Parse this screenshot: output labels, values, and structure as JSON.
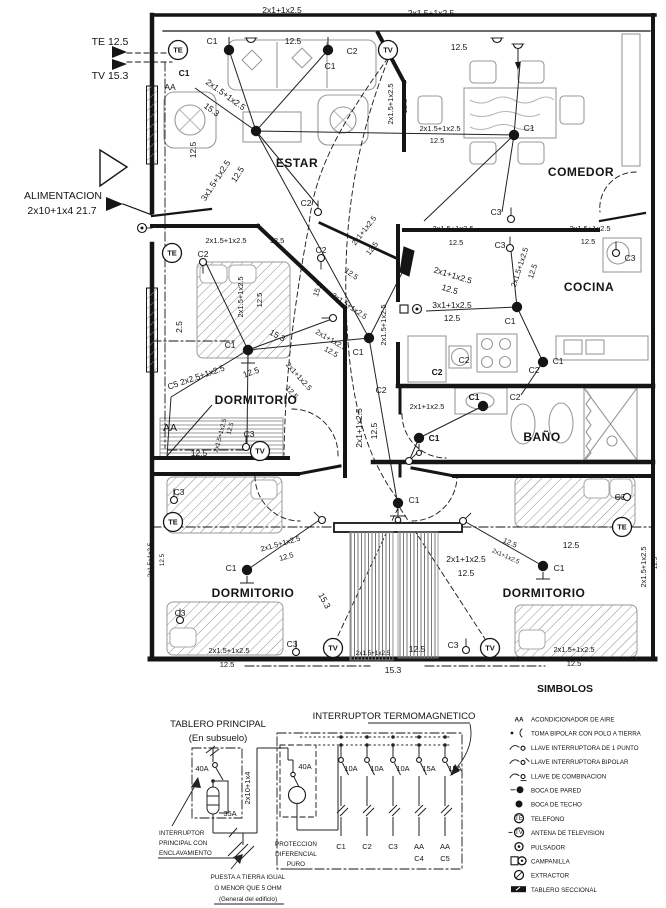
{
  "plan": {
    "feed": {
      "te": "TE 12.5",
      "tv": "TV 15.3",
      "alim1": "ALIMENTACION",
      "alim2": "2x10+1x4  21.7"
    },
    "rooms": [
      {
        "label": "ESTAR",
        "x": 297,
        "y": 167
      },
      {
        "label": "COMEDOR",
        "x": 581,
        "y": 176
      },
      {
        "label": "COCINA",
        "x": 589,
        "y": 291
      },
      {
        "label": "BAÑO",
        "x": 542,
        "y": 441
      },
      {
        "label": "DORMITORIO",
        "x": 256,
        "y": 404
      },
      {
        "label": "DORMITORIO",
        "x": 253,
        "y": 597
      },
      {
        "label": "DORMITORIO",
        "x": 544,
        "y": 597
      }
    ],
    "annotations": [
      {
        "t": "2x1+1x2.5",
        "x": 282,
        "y": 13
      },
      {
        "t": "12.5",
        "x": 293,
        "y": 44
      },
      {
        "t": "2x1.5+1x2.5",
        "x": 431,
        "y": 16
      },
      {
        "t": "12.5",
        "x": 459,
        "y": 50
      },
      {
        "t": "C1",
        "x": 212,
        "y": 44
      },
      {
        "t": "C2",
        "x": 352,
        "y": 54
      },
      {
        "t": "C1",
        "x": 330,
        "y": 69
      },
      {
        "t": "AA",
        "x": 170,
        "y": 90
      },
      {
        "t": "C1",
        "x": 184,
        "y": 76,
        "c": "bold"
      },
      {
        "t": "2x1.5+1x2.5",
        "x": 224,
        "y": 97,
        "r": 36
      },
      {
        "t": "15.3",
        "x": 210,
        "y": 112,
        "r": 36
      },
      {
        "t": "12.5",
        "x": 196,
        "y": 150,
        "r": -90
      },
      {
        "t": "3x1.5+1x2.5",
        "x": 218,
        "y": 182,
        "r": -57
      },
      {
        "t": "12.5",
        "x": 240,
        "y": 176,
        "r": -57
      },
      {
        "t": "C2",
        "x": 306,
        "y": 206
      },
      {
        "t": "2x1.5+1x2.5",
        "x": 393,
        "y": 104,
        "r": -90,
        "c": "sm"
      },
      {
        "t": "12.5",
        "x": 407,
        "y": 106,
        "r": -90,
        "c": "sm"
      },
      {
        "t": "C1",
        "x": 529,
        "y": 131
      },
      {
        "t": "2x1.5+1x2.5",
        "x": 440,
        "y": 131,
        "c": "sm"
      },
      {
        "t": "12.5",
        "x": 437,
        "y": 143,
        "c": "sm"
      },
      {
        "t": "C3",
        "x": 496,
        "y": 215
      },
      {
        "t": "2x1.5+1x2.5",
        "x": 453,
        "y": 231,
        "c": "sm"
      },
      {
        "t": "12.5",
        "x": 456,
        "y": 245,
        "c": "sm"
      },
      {
        "t": "2x1.5+1x2.5",
        "x": 590,
        "y": 231,
        "c": "sm"
      },
      {
        "t": "12.5",
        "x": 588,
        "y": 244,
        "c": "sm"
      },
      {
        "t": "C3",
        "x": 500,
        "y": 248
      },
      {
        "t": "C3",
        "x": 630,
        "y": 261
      },
      {
        "t": "2x1.5+1x2.5",
        "x": 522,
        "y": 268,
        "r": -72,
        "c": "sm"
      },
      {
        "t": "12.5",
        "x": 535,
        "y": 272,
        "r": -72,
        "c": "sm"
      },
      {
        "t": "2x1+1x2.5",
        "x": 452,
        "y": 278,
        "r": 17
      },
      {
        "t": "12.5",
        "x": 449,
        "y": 292,
        "r": 17
      },
      {
        "t": "3x1+1x2.5",
        "x": 452,
        "y": 308
      },
      {
        "t": "12.5",
        "x": 452,
        "y": 321
      },
      {
        "t": "C1",
        "x": 510,
        "y": 324
      },
      {
        "t": "C2",
        "x": 464,
        "y": 363
      },
      {
        "t": "C2",
        "x": 534,
        "y": 373
      },
      {
        "t": "C1",
        "x": 558,
        "y": 364
      },
      {
        "t": "C2",
        "x": 437,
        "y": 375,
        "c": "bold"
      },
      {
        "t": "C2",
        "x": 381,
        "y": 393
      },
      {
        "t": "C1",
        "x": 358,
        "y": 355
      },
      {
        "t": "2x1.5+1x2.5",
        "x": 386,
        "y": 325,
        "r": -90,
        "c": "sm"
      },
      {
        "t": "2x1.5+1x2.5",
        "x": 348,
        "y": 308,
        "r": 34,
        "c": "sm"
      },
      {
        "t": "12.5",
        "x": 350,
        "y": 276,
        "r": 34,
        "c": "sm"
      },
      {
        "t": "2x1+1x2.5",
        "x": 366,
        "y": 232,
        "r": -52,
        "c": "sm"
      },
      {
        "t": "12.5",
        "x": 374,
        "y": 250,
        "r": -52,
        "c": "sm"
      },
      {
        "t": "15.3",
        "x": 320,
        "y": 290,
        "r": -72,
        "c": "sm"
      },
      {
        "t": "2x1.5+1x2.5",
        "x": 226,
        "y": 243,
        "c": "sm"
      },
      {
        "t": "12.5",
        "x": 277,
        "y": 243,
        "c": "sm"
      },
      {
        "t": "C2",
        "x": 203,
        "y": 257
      },
      {
        "t": "C2",
        "x": 321,
        "y": 253
      },
      {
        "t": "2x1.5+1x2.5",
        "x": 243,
        "y": 297,
        "r": -90,
        "c": "sm"
      },
      {
        "t": "12.5",
        "x": 262,
        "y": 300,
        "r": -90,
        "c": "sm"
      },
      {
        "t": "2.5",
        "x": 182,
        "y": 327,
        "r": -90
      },
      {
        "t": "C1",
        "x": 230,
        "y": 348
      },
      {
        "t": "15.3",
        "x": 276,
        "y": 338,
        "r": 28
      },
      {
        "t": "2x1+1x2.5",
        "x": 330,
        "y": 342,
        "r": 30,
        "c": "sm"
      },
      {
        "t": "12.5",
        "x": 330,
        "y": 354,
        "r": 30,
        "c": "sm"
      },
      {
        "t": "C5 2x2.5+1x2.5",
        "x": 197,
        "y": 380,
        "r": -19
      },
      {
        "t": "12.5",
        "x": 252,
        "y": 375,
        "r": -19
      },
      {
        "t": "2x1+1x2.5",
        "x": 297,
        "y": 378,
        "r": 48,
        "c": "sm"
      },
      {
        "t": "12.5",
        "x": 290,
        "y": 394,
        "r": 48,
        "c": "sm"
      },
      {
        "t": "2x1+1x2.5",
        "x": 362,
        "y": 428,
        "r": -90
      },
      {
        "t": "12.5",
        "x": 377,
        "y": 431,
        "r": -90
      },
      {
        "t": "AA",
        "x": 170,
        "y": 431,
        "c": "lg"
      },
      {
        "t": "12.5",
        "x": 199,
        "y": 456
      },
      {
        "t": "C3",
        "x": 249,
        "y": 437
      },
      {
        "t": "2x1.5+1x2.5",
        "x": 222,
        "y": 436,
        "r": -75,
        "c": "xs"
      },
      {
        "t": "12.5",
        "x": 232,
        "y": 429,
        "r": -75,
        "c": "xs"
      },
      {
        "t": "2x1+1x2.5",
        "x": 427,
        "y": 409,
        "c": "sm"
      },
      {
        "t": "C1",
        "x": 474,
        "y": 400,
        "c": "bold"
      },
      {
        "t": "C2",
        "x": 515,
        "y": 400
      },
      {
        "t": "C1",
        "x": 434,
        "y": 441,
        "c": "bold"
      },
      {
        "t": "C1",
        "x": 414,
        "y": 503
      },
      {
        "t": "15.3",
        "x": 322,
        "y": 602,
        "r": 62
      },
      {
        "t": "C3",
        "x": 179,
        "y": 495
      },
      {
        "t": "2x1.5+1x2.5",
        "x": 152,
        "y": 560,
        "r": -90,
        "c": "xs"
      },
      {
        "t": "12.5",
        "x": 164,
        "y": 560,
        "r": -90,
        "c": "xs"
      },
      {
        "t": "2x1.5+1x2.5",
        "x": 281,
        "y": 546,
        "r": -16,
        "c": "sm"
      },
      {
        "t": "12.5",
        "x": 287,
        "y": 559,
        "r": -16,
        "c": "sm"
      },
      {
        "t": "C1",
        "x": 231,
        "y": 571
      },
      {
        "t": "C3",
        "x": 180,
        "y": 616
      },
      {
        "t": "2x1.5+1x2.5",
        "x": 229,
        "y": 653,
        "c": "sm"
      },
      {
        "t": "12.5",
        "x": 227,
        "y": 667,
        "c": "sm"
      },
      {
        "t": "C3",
        "x": 292,
        "y": 647
      },
      {
        "t": "2x1.5+1x2.5",
        "x": 373,
        "y": 655,
        "c": "xs"
      },
      {
        "t": "12.5",
        "x": 417,
        "y": 652
      },
      {
        "t": "15.3",
        "x": 393,
        "y": 673
      },
      {
        "t": "C3",
        "x": 620,
        "y": 500
      },
      {
        "t": "12.5",
        "x": 571,
        "y": 548
      },
      {
        "t": "12.5",
        "x": 509,
        "y": 545,
        "r": 24,
        "c": "sm"
      },
      {
        "t": "2x1+1x2.5",
        "x": 505,
        "y": 558,
        "r": 24,
        "c": "xs"
      },
      {
        "t": "2x1+1x2.5",
        "x": 466,
        "y": 562
      },
      {
        "t": "12.5",
        "x": 466,
        "y": 576
      },
      {
        "t": "C1",
        "x": 559,
        "y": 571
      },
      {
        "t": "2x1.5+1x2.5",
        "x": 646,
        "y": 567,
        "r": -90,
        "c": "sm"
      },
      {
        "t": "12.5",
        "x": 657,
        "y": 563,
        "r": -90,
        "c": "xs"
      },
      {
        "t": "C3",
        "x": 453,
        "y": 648
      },
      {
        "t": "2x1.5+1x2.5",
        "x": 574,
        "y": 652,
        "c": "sm"
      },
      {
        "t": "12.5",
        "x": 574,
        "y": 666,
        "c": "sm"
      }
    ],
    "nodes": [
      [
        229,
        50
      ],
      [
        328,
        50
      ],
      [
        256,
        131
      ],
      [
        514,
        135
      ],
      [
        248,
        350
      ],
      [
        369,
        338
      ],
      [
        517,
        307
      ],
      [
        543,
        362
      ],
      [
        483,
        406
      ],
      [
        419,
        438
      ],
      [
        398,
        503
      ],
      [
        247,
        570
      ],
      [
        543,
        566
      ]
    ],
    "comm_outlets": [
      {
        "t": "TE",
        "x": 178,
        "y": 50
      },
      {
        "t": "TV",
        "x": 388,
        "y": 50
      },
      {
        "t": "TE",
        "x": 172,
        "y": 253
      },
      {
        "t": "TV",
        "x": 260,
        "y": 451
      },
      {
        "t": "TE",
        "x": 173,
        "y": 522
      },
      {
        "t": "TV",
        "x": 333,
        "y": 648
      },
      {
        "t": "TV",
        "x": 490,
        "y": 648
      },
      {
        "t": "TE",
        "x": 622,
        "y": 527
      }
    ],
    "fixtures": [
      {
        "type": "socket",
        "x": 251,
        "y": 38
      },
      {
        "type": "socket",
        "x": 497,
        "y": 38
      },
      {
        "type": "socket",
        "x": 518,
        "y": 44
      },
      {
        "type": "switch",
        "x": 318,
        "y": 212,
        "a": 90
      },
      {
        "type": "switch",
        "x": 511,
        "y": 219,
        "a": 90
      },
      {
        "type": "switch",
        "x": 510,
        "y": 248,
        "a": 90
      },
      {
        "type": "switch",
        "x": 616,
        "y": 253,
        "a": 90
      },
      {
        "type": "switch",
        "x": 203,
        "y": 262,
        "a": -90
      },
      {
        "type": "switch",
        "x": 321,
        "y": 258,
        "a": -90
      },
      {
        "type": "switch",
        "x": 322,
        "y": 520,
        "a": 135
      },
      {
        "type": "switch",
        "x": 463,
        "y": 521,
        "a": 45
      },
      {
        "type": "switch",
        "x": 246,
        "y": 447,
        "a": 90
      },
      {
        "type": "switch",
        "x": 174,
        "y": 500,
        "a": 0
      },
      {
        "type": "switch",
        "x": 180,
        "y": 620,
        "a": 0
      },
      {
        "type": "switch",
        "x": 296,
        "y": 652,
        "a": 90
      },
      {
        "type": "switch",
        "x": 466,
        "y": 650,
        "a": 90
      },
      {
        "type": "switch",
        "x": 333,
        "y": 318,
        "a": 180
      },
      {
        "type": "switch",
        "x": 627,
        "y": 497,
        "a": 180
      },
      {
        "type": "switch",
        "x": 409,
        "y": 461,
        "a": 45
      },
      {
        "type": "pulsador",
        "x": 142,
        "y": 228
      },
      {
        "type": "pulsador",
        "x": 417,
        "y": 309
      },
      {
        "type": "bellbox",
        "x": 404,
        "y": 309
      }
    ]
  },
  "panel": {
    "title": "TABLERO PRINCIPAL",
    "subtitle": "(En subsuelo)",
    "thermal_title": "INTERRUPTOR TERMOMAGNETICO",
    "annotations": [
      {
        "t": "40A",
        "x": 202,
        "y": 771,
        "c": "sm"
      },
      {
        "t": "35A",
        "x": 230,
        "y": 816,
        "c": "sm"
      },
      {
        "t": "2x10+1x4",
        "x": 250,
        "y": 788,
        "r": -90,
        "c": "sm"
      },
      {
        "t": "40A",
        "x": 305,
        "y": 769,
        "c": "sm"
      },
      {
        "t": "INTERRUPTOR",
        "x": 159,
        "y": 835,
        "c": "xs",
        "an": "start"
      },
      {
        "t": "PRINCIPAL CON",
        "x": 159,
        "y": 845,
        "c": "xs",
        "an": "start"
      },
      {
        "t": "ENCLAVAMIENTO",
        "x": 159,
        "y": 855,
        "c": "xs",
        "an": "start"
      },
      {
        "t": "PROTECCION",
        "x": 296,
        "y": 846,
        "c": "xs"
      },
      {
        "t": "DIFERENCIAL",
        "x": 296,
        "y": 856,
        "c": "xs"
      },
      {
        "t": "PURO",
        "x": 296,
        "y": 866,
        "c": "xs"
      },
      {
        "t": "PUESTA A TIERRA IGUAL",
        "x": 248,
        "y": 879,
        "c": "xs"
      },
      {
        "t": "O MENOR QUE 5 OHM",
        "x": 248,
        "y": 890,
        "c": "xs"
      },
      {
        "t": "(General del edificio)",
        "x": 248,
        "y": 901,
        "c": "xs"
      }
    ],
    "breakers": [
      {
        "amp": "10A",
        "circuits": [
          "C1"
        ]
      },
      {
        "amp": "10A",
        "circuits": [
          "C2"
        ]
      },
      {
        "amp": "10A",
        "circuits": [
          "C3"
        ]
      },
      {
        "amp": "15A",
        "circuits": [
          "AA",
          "C4"
        ]
      },
      {
        "amp": "15A",
        "circuits": [
          "AA",
          "C5"
        ]
      }
    ]
  },
  "legend": {
    "title": "SIMBOLOS",
    "items": [
      {
        "icon": "aa",
        "label": "ACONDICIONADOR DE AIRE"
      },
      {
        "icon": "toma",
        "label": "TOMA BIPOLAR CON POLO A TIERRA"
      },
      {
        "icon": "llave1",
        "label": "LLAVE INTERRUPTORA DE 1 PUNTO"
      },
      {
        "icon": "llave2",
        "label": "LLAVE INTERRUPTORA BIPOLAR"
      },
      {
        "icon": "llavec",
        "label": "LLAVE DE COMBINACION"
      },
      {
        "icon": "bocap",
        "label": "BOCA DE PARED"
      },
      {
        "icon": "bocat",
        "label": "BOCA DE TECHO"
      },
      {
        "icon": "te",
        "label": "TELEFONO"
      },
      {
        "icon": "tv",
        "label": "ANTENA DE TELEVISION"
      },
      {
        "icon": "puls",
        "label": "PULSADOR"
      },
      {
        "icon": "camp",
        "label": "CAMPANILLA"
      },
      {
        "icon": "extr",
        "label": "EXTRACTOR"
      },
      {
        "icon": "tabl",
        "label": "TABLERO SECCIONAL"
      }
    ]
  }
}
